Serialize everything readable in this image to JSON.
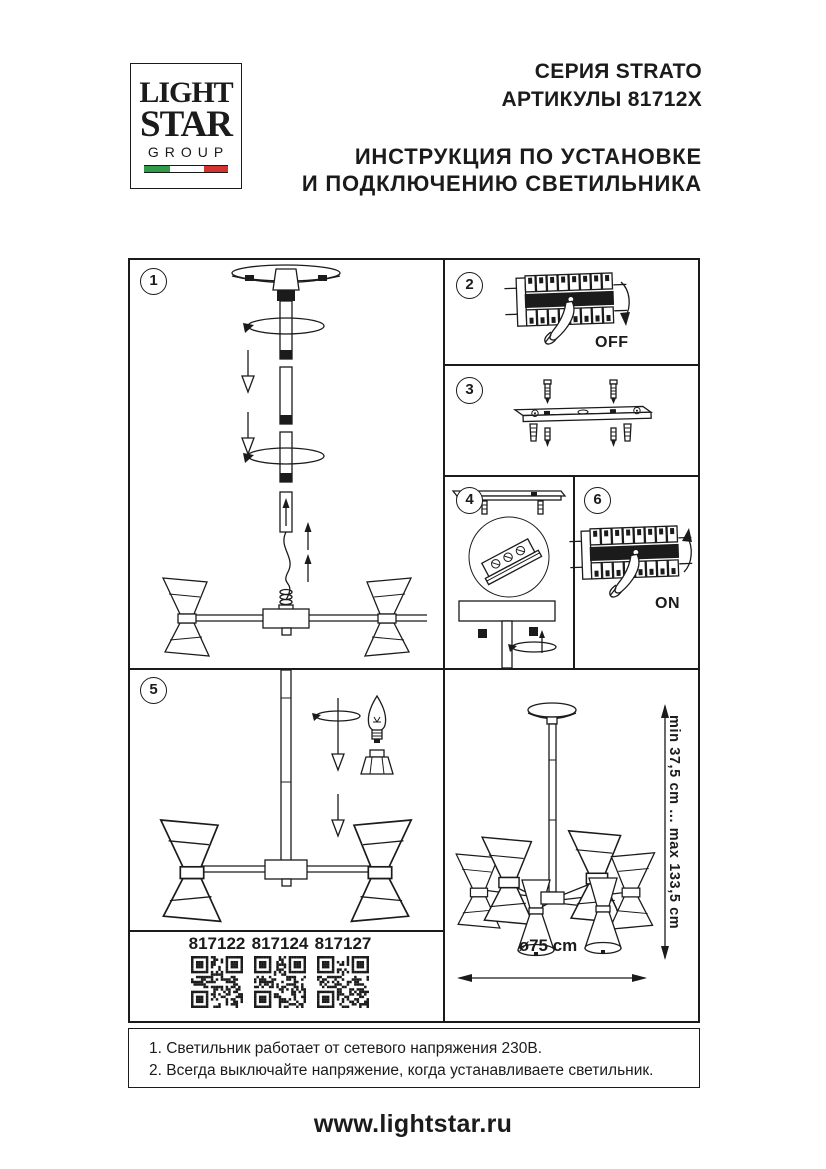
{
  "colors": {
    "ink": "#1b1b1b",
    "paper": "#ffffff",
    "flag_green": "#2f9b4a",
    "flag_white": "#ffffff",
    "flag_red": "#d23331"
  },
  "logo": {
    "word1": "LIGHT",
    "word2": "STAR",
    "word3": "GROUP"
  },
  "header": {
    "series": "СЕРИЯ STRATO",
    "articles": "АРТИКУЛЫ 81712X",
    "title_line1": "ИНСТРУКЦИЯ ПО УСТАНОВКЕ",
    "title_line2": "И ПОДКЛЮЧЕНИЮ СВЕТИЛЬНИКА"
  },
  "steps": {
    "n1": "1",
    "n2": "2",
    "n3": "3",
    "n4": "4",
    "n5": "5",
    "n6": "6"
  },
  "switch_labels": {
    "off": "OFF",
    "on": "ON"
  },
  "dimensions": {
    "height_range": "min 37,5 cm ... max 133,5 cm",
    "diameter": "ø75 cm"
  },
  "qr_codes": [
    {
      "label": "817122"
    },
    {
      "label": "817124"
    },
    {
      "label": "817127"
    }
  ],
  "notes": {
    "line1": "1. Светильник работает от сетевого напряжения 230В.",
    "line2": "2. Всегда выключайте напряжение, когда устанавливаете светильник."
  },
  "footer": {
    "website": "www.lightstar.ru"
  }
}
